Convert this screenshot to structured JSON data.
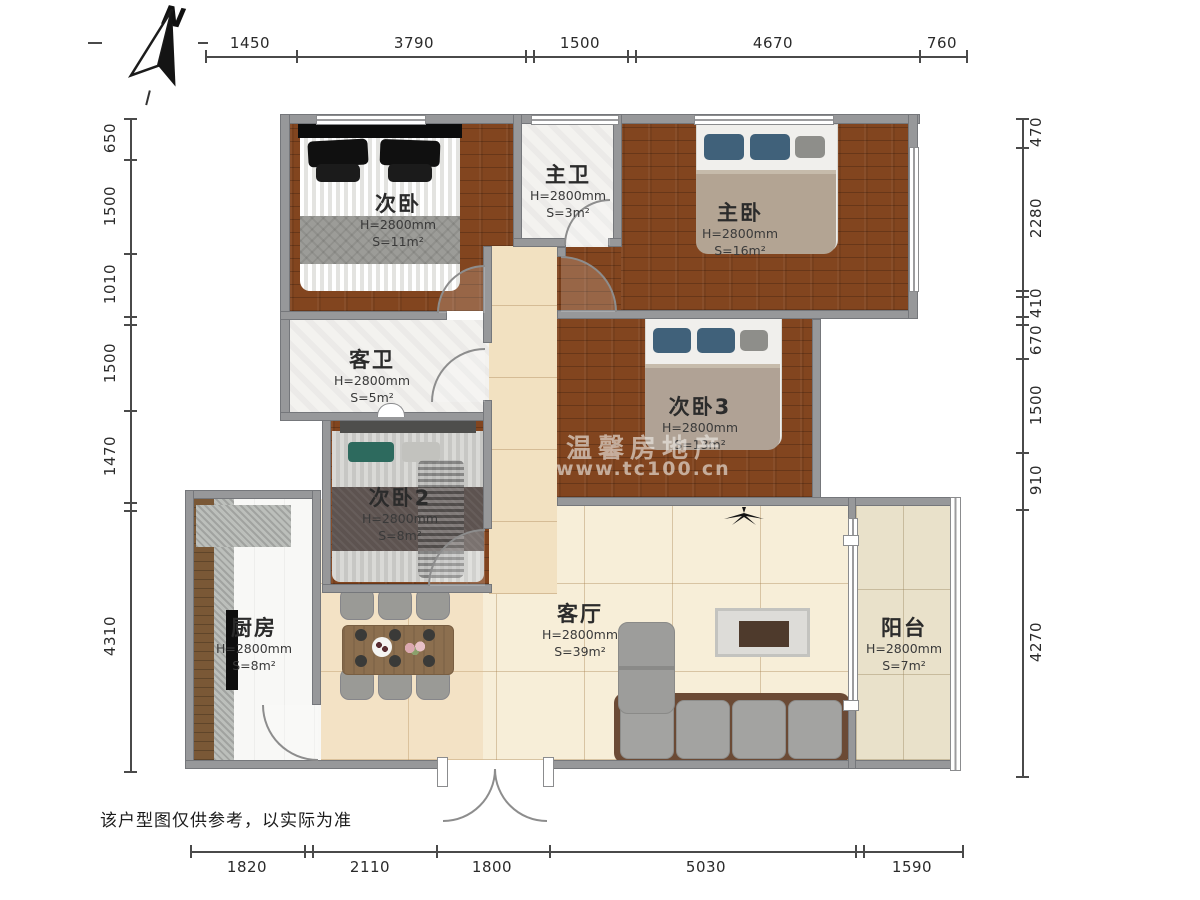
{
  "meta": {
    "disclaimer": "该户型图仅供参考，以实际为准",
    "compass_label": "N"
  },
  "watermark": {
    "line1": "温馨房地产",
    "line2": "www.tc100.cn"
  },
  "dimensions": {
    "top": [
      "1450",
      "3790",
      "1500",
      "4670",
      "760"
    ],
    "bottom": [
      "1820",
      "2110",
      "1800",
      "5030",
      "1590"
    ],
    "left": [
      "650",
      "1500",
      "1010",
      "1500",
      "1470",
      "4310"
    ],
    "right": [
      "470",
      "2280",
      "410",
      "670",
      "1500",
      "910",
      "4270"
    ]
  },
  "rooms": [
    {
      "name": "次卧",
      "height": "H=2800mm",
      "area": "S=11m²"
    },
    {
      "name": "主卫",
      "height": "H=2800mm",
      "area": "S=3m²"
    },
    {
      "name": "主卧",
      "height": "H=2800mm",
      "area": "S=16m²"
    },
    {
      "name": "客卫",
      "height": "H=2800mm",
      "area": "S=5m²"
    },
    {
      "name": "次卧3",
      "height": "H=2800mm",
      "area": "S=13m²"
    },
    {
      "name": "次卧2",
      "height": "H=2800mm",
      "area": "S=8m²"
    },
    {
      "name": "厨房",
      "height": "H=2800mm",
      "area": "S=8m²"
    },
    {
      "name": "客厅",
      "height": "H=2800mm",
      "area": "S=39m²"
    },
    {
      "name": "阳台",
      "height": "H=2800mm",
      "area": "S=7m²"
    }
  ],
  "colors": {
    "wall": "#97989a",
    "wood_floor": "#82451f",
    "main_tile": "#f7eed8",
    "balcony_tile": "#e9e1ca",
    "bath_tile": "#f3f2ef",
    "bed_pillow_blue": "#40617a",
    "bed_pillow_teal": "#2d6a5e",
    "sofa_gray": "#a3a3a1",
    "sofa_base_brown": "#6b4a35"
  }
}
